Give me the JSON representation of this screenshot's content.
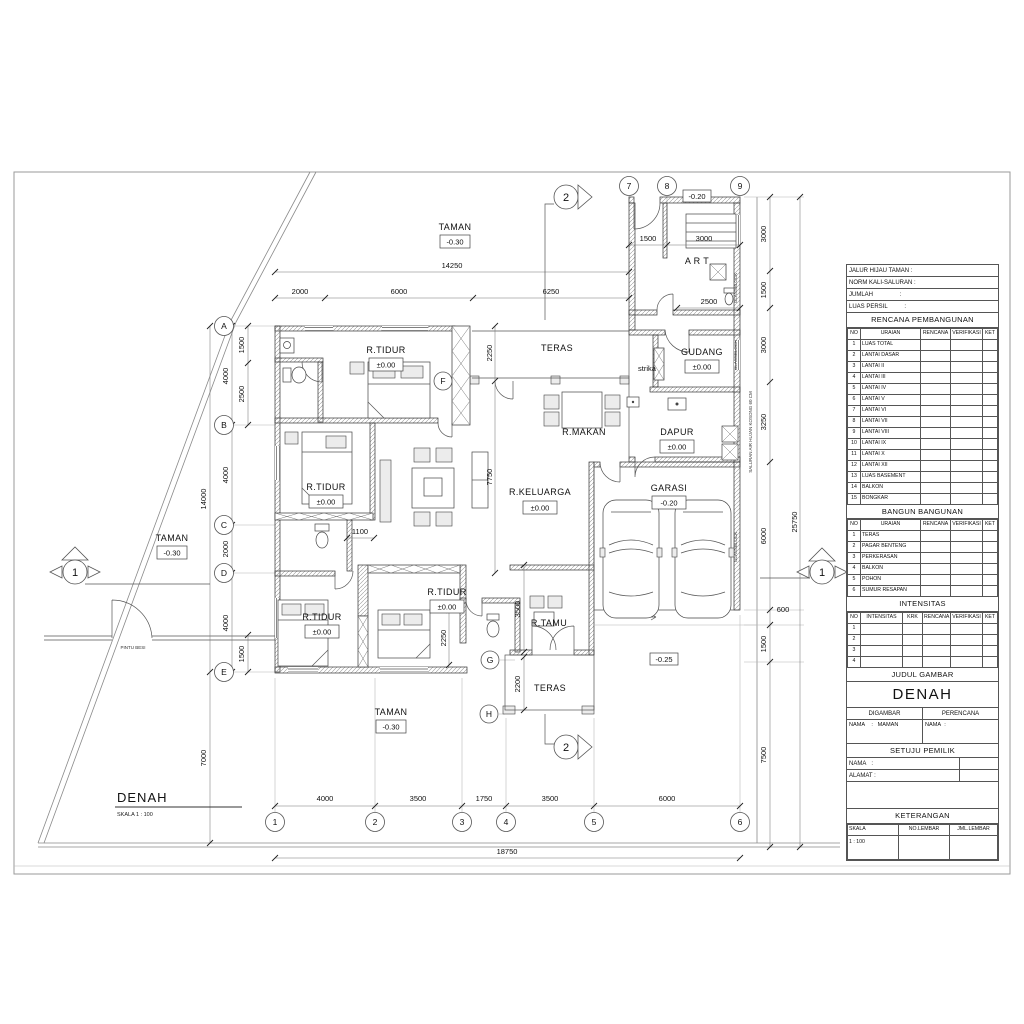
{
  "sheet": {
    "drawing_title": "DENAH",
    "drawing_scale": "SKALA  1 : 100"
  },
  "plan": {
    "rooms": {
      "taman": "TAMAN",
      "rtidur": "R.TIDUR",
      "teras": "TERAS",
      "rmakan": "R.MAKAN",
      "rkeluarga": "R.KELUARGA",
      "rtamu": "R.TAMU",
      "dapur": "DAPUR",
      "gudang": "GUDANG",
      "garasi": "GARASI",
      "art": "A R T",
      "strika": "strika"
    },
    "levels": {
      "zero": "±0.00",
      "m020": "-0.20",
      "m025": "-0.25",
      "m030": "-0.30"
    },
    "notes": {
      "pintu_besi": "PINTU BESI",
      "glassblock": "GLASSBLOCK",
      "saluran": "SALURAN AIR HUJAN KOSONG 60 CM"
    },
    "grid": {
      "cols": [
        "1",
        "2",
        "3",
        "4",
        "5",
        "6"
      ],
      "cols_top": [
        "7",
        "8",
        "9"
      ],
      "rows": [
        "A",
        "B",
        "C",
        "D",
        "E"
      ],
      "rows_right": [
        "F",
        "G",
        "H"
      ],
      "section_v": "2",
      "section_h": "1"
    },
    "dims": {
      "top_total": "14250",
      "top_sub": [
        "2000",
        "6000",
        "6250"
      ],
      "tr_sub": [
        "1500",
        "3000"
      ],
      "art_w": "2500",
      "bottom_sub": [
        "4000",
        "3500",
        "1750",
        "3500",
        "6000"
      ],
      "bottom_total": "18750",
      "left_main": [
        "4000",
        "4000",
        "2000",
        "4000"
      ],
      "left_sub": [
        "1500",
        "2500",
        "1500"
      ],
      "left_total": "14000",
      "front": "7000",
      "right_chain": [
        "3000",
        "1500",
        "3000",
        "3250",
        "6000",
        "600",
        "1500",
        "7500"
      ],
      "right_total": "25750",
      "inner": [
        "2250",
        "7750",
        "1100",
        "2250",
        "3500",
        "2200"
      ]
    }
  },
  "titleblock": {
    "info": [
      "JALUR HIJAU TAMAN  :",
      "NORM KALI-SALURAN :",
      "JUMLAH                :",
      "LUAS PERSIL          :"
    ],
    "rencana": {
      "title": "RENCANA PEMBANGUNAN",
      "headers": [
        "NO",
        "URAIAN",
        "RENCANA",
        "VERIFIKASI",
        "KET"
      ],
      "rows": [
        [
          "1",
          "LUAS TOTAL"
        ],
        [
          "2",
          "LANTAI DASAR"
        ],
        [
          "3",
          "LANTAI II"
        ],
        [
          "4",
          "LANTAI III"
        ],
        [
          "5",
          "LANTAI IV"
        ],
        [
          "6",
          "LANTAI V"
        ],
        [
          "7",
          "LANTAI VI"
        ],
        [
          "8",
          "LANTAI VII"
        ],
        [
          "9",
          "LANTAI VIII"
        ],
        [
          "10",
          "LANTAI IX"
        ],
        [
          "11",
          "LANTAI X"
        ],
        [
          "12",
          "LANTAI XII"
        ],
        [
          "13",
          "LUAS BASEMENT"
        ],
        [
          "14",
          "BALKON"
        ],
        [
          "15",
          "BONGKAR"
        ]
      ]
    },
    "bangun": {
      "title": "BANGUN BANGUNAN",
      "headers": [
        "NO",
        "URAIAN",
        "RENCANA",
        "VERIFIKASI",
        "KET"
      ],
      "rows": [
        [
          "1",
          "TERAS"
        ],
        [
          "2",
          "PAGAR BENTENG"
        ],
        [
          "3",
          "PERKERASAN"
        ],
        [
          "4",
          "BALKON"
        ],
        [
          "5",
          "POHON"
        ],
        [
          "6",
          "SUMUR  RESAPAN"
        ]
      ]
    },
    "intensitas": {
      "title": "INTENSITAS",
      "headers": [
        "NO",
        "INTENSITAS",
        "KRK",
        "RENCANA",
        "VERIFIKASI",
        "KET"
      ],
      "rows": [
        [
          "1"
        ],
        [
          "2"
        ],
        [
          "3"
        ],
        [
          "4"
        ]
      ]
    },
    "judul": {
      "title": "JUDUL GAMBAR",
      "value": "DENAH"
    },
    "pelaksana": {
      "digambar": "DIGAMBAR",
      "perencana": "PERENCANA",
      "nama_digambar": "NAMA    :   MAMAN",
      "nama_perencana": "NAMA  :"
    },
    "setuju": {
      "title": "SETUJU PEMILIK",
      "nama": "NAMA   :",
      "alamat": "ALAMAT :"
    },
    "keterangan": {
      "title": "KETERANGAN",
      "headers": [
        "SKALA",
        "NO.LEMBAR",
        "JML.LEMBAR"
      ],
      "skala_value": "1 : 100"
    }
  }
}
